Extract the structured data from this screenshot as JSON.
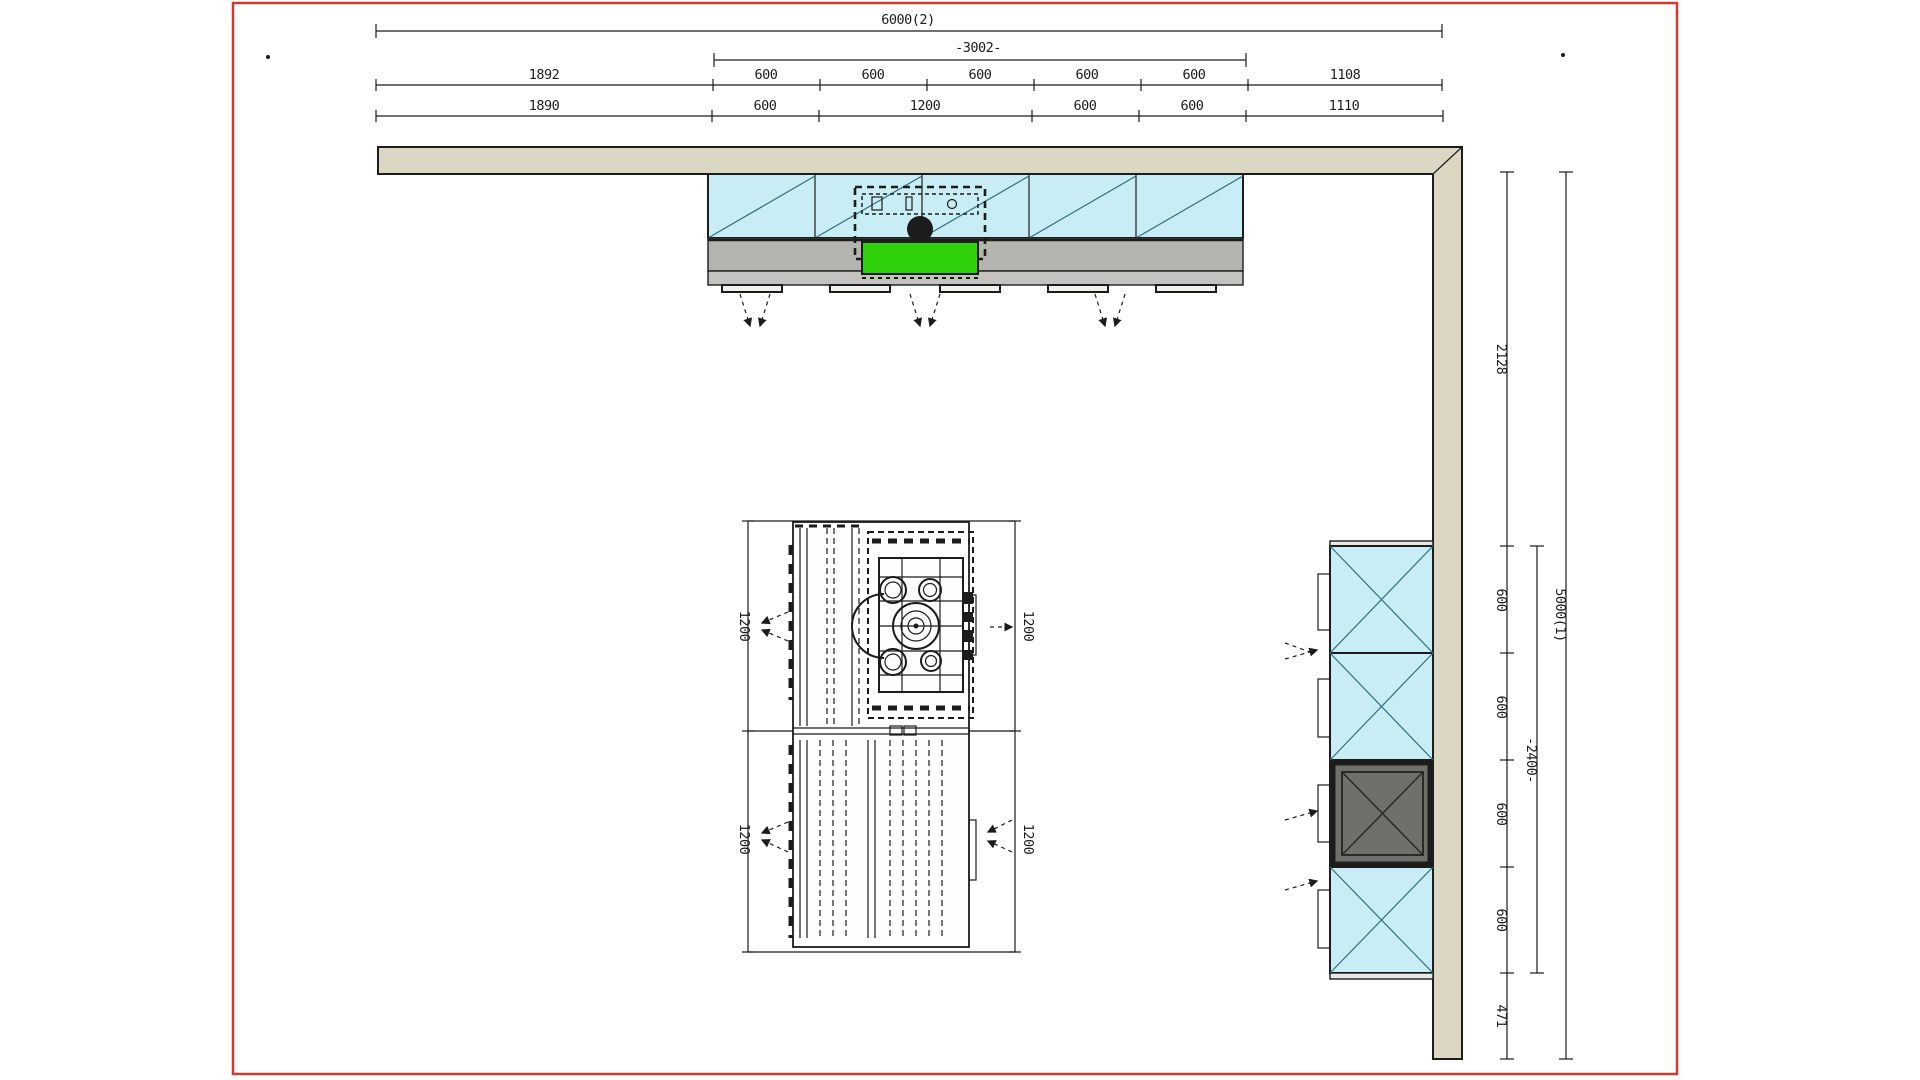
{
  "drawing_type": "kitchen-floor-plan",
  "dims": {
    "top": {
      "total": "6000(2)",
      "sub": "-3002-",
      "row1": [
        "1892",
        "600",
        "600",
        "600",
        "600",
        "600",
        "1108"
      ],
      "row2": [
        "1890",
        "600",
        "1200",
        "600",
        "600",
        "1110"
      ]
    },
    "right": {
      "total": "5000(1)",
      "sub": "-2400-",
      "segments": [
        "2128",
        "600",
        "600",
        "600",
        "600",
        "471"
      ]
    },
    "island": {
      "top_left": "1200",
      "top_right": "1200",
      "bottom_left": "1200",
      "bottom_right": "1200"
    }
  },
  "colors": {
    "ink": "#1c1c1c",
    "red": "#d03a30",
    "wall": "#dcd7c2",
    "cyan": "#c9edf4",
    "teal": "#2f6f80",
    "counter": "#b5b4b0",
    "plinth": "#c4c3bf",
    "green": "#2fd10b",
    "oven": "#70706a",
    "paper": "#ffffff"
  }
}
